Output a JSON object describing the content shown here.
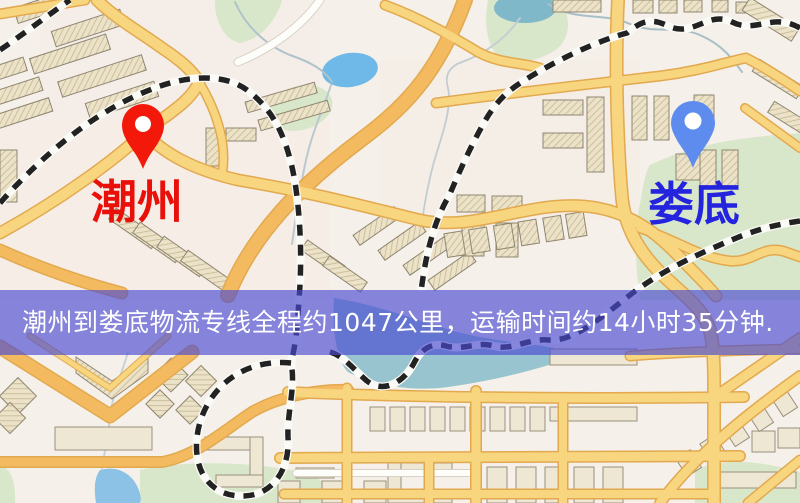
{
  "map": {
    "markers": {
      "origin": {
        "label": "潮州",
        "pin_color": "#f3190a",
        "label_color": "#e9100a"
      },
      "destination": {
        "label": "娄底",
        "pin_color": "#5e8cee",
        "label_color": "#2424de"
      }
    },
    "legend_colors": {
      "road_yellow": "#f8d57f",
      "road_orange": "#f3ba60",
      "park_green": "#d8e7c9",
      "water_blue": "#6fb9e8",
      "building_beige": "#ebe2c8"
    }
  },
  "banner": {
    "text": "潮州到娄底物流专线全程约1047公里，运输时间约14小时35分钟.",
    "background_color": "#4a4ad2",
    "text_color": "#ffffff"
  },
  "route": {
    "origin": "潮州",
    "destination": "娄底",
    "distance_text": "约1047公里",
    "duration_text": "约14小时35分钟"
  }
}
